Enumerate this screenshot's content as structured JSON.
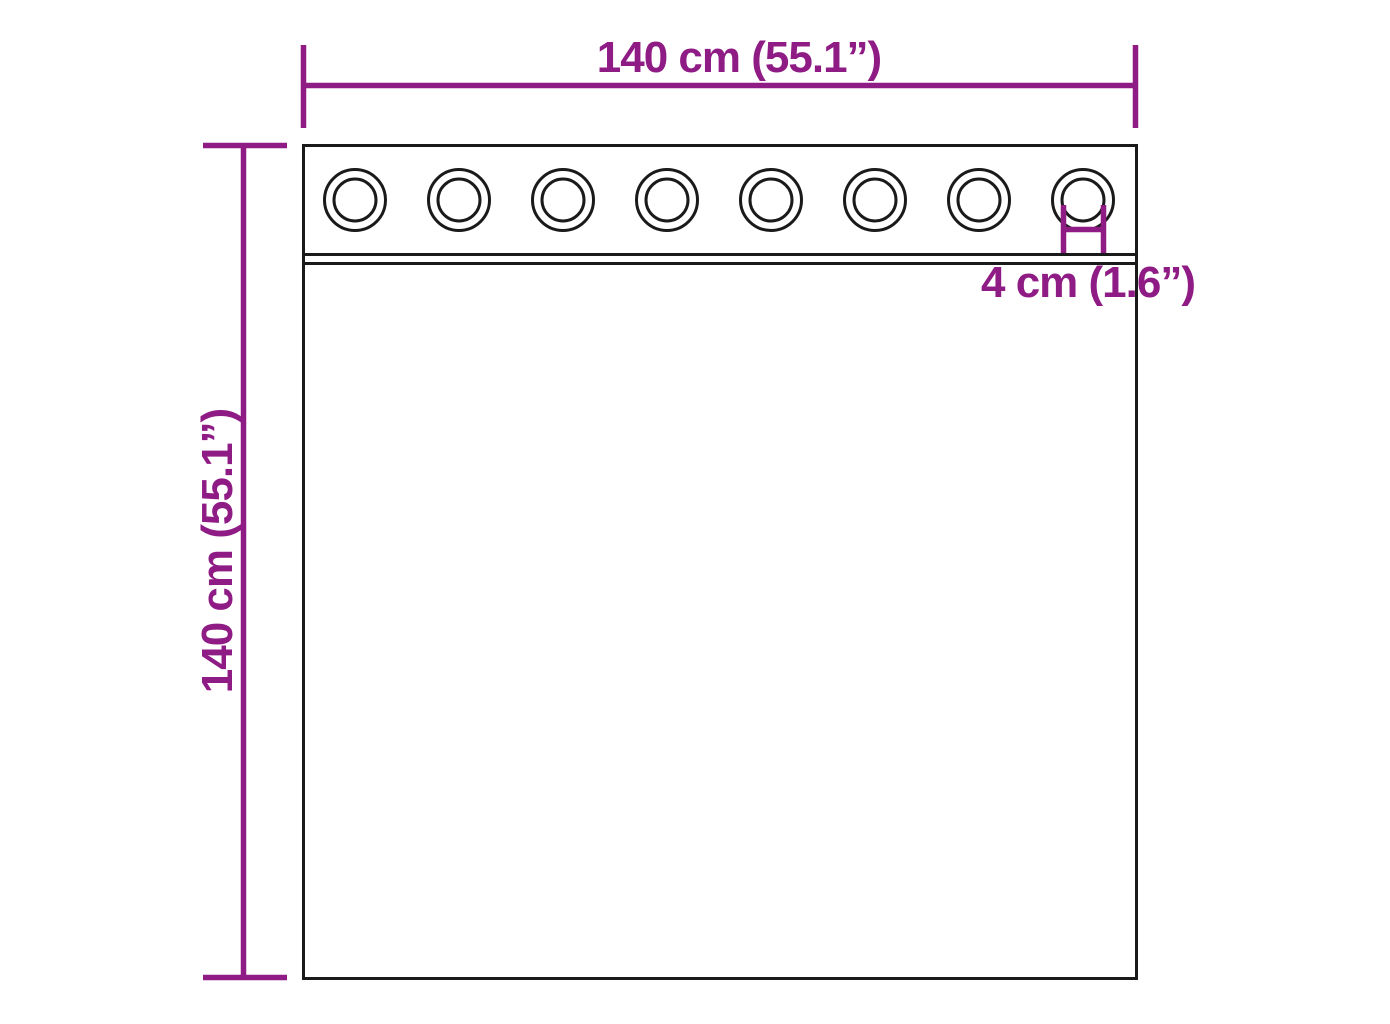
{
  "diagram": {
    "colors": {
      "dimension": "#8f1b85",
      "outline": "#1a1a1a",
      "background": "#ffffff"
    },
    "dimensions": {
      "width_label": "140 cm (55.1”)",
      "height_label": "140 cm (55.1”)",
      "grommet_label": "4 cm (1.6”)"
    },
    "grommets": {
      "count": 8
    }
  }
}
